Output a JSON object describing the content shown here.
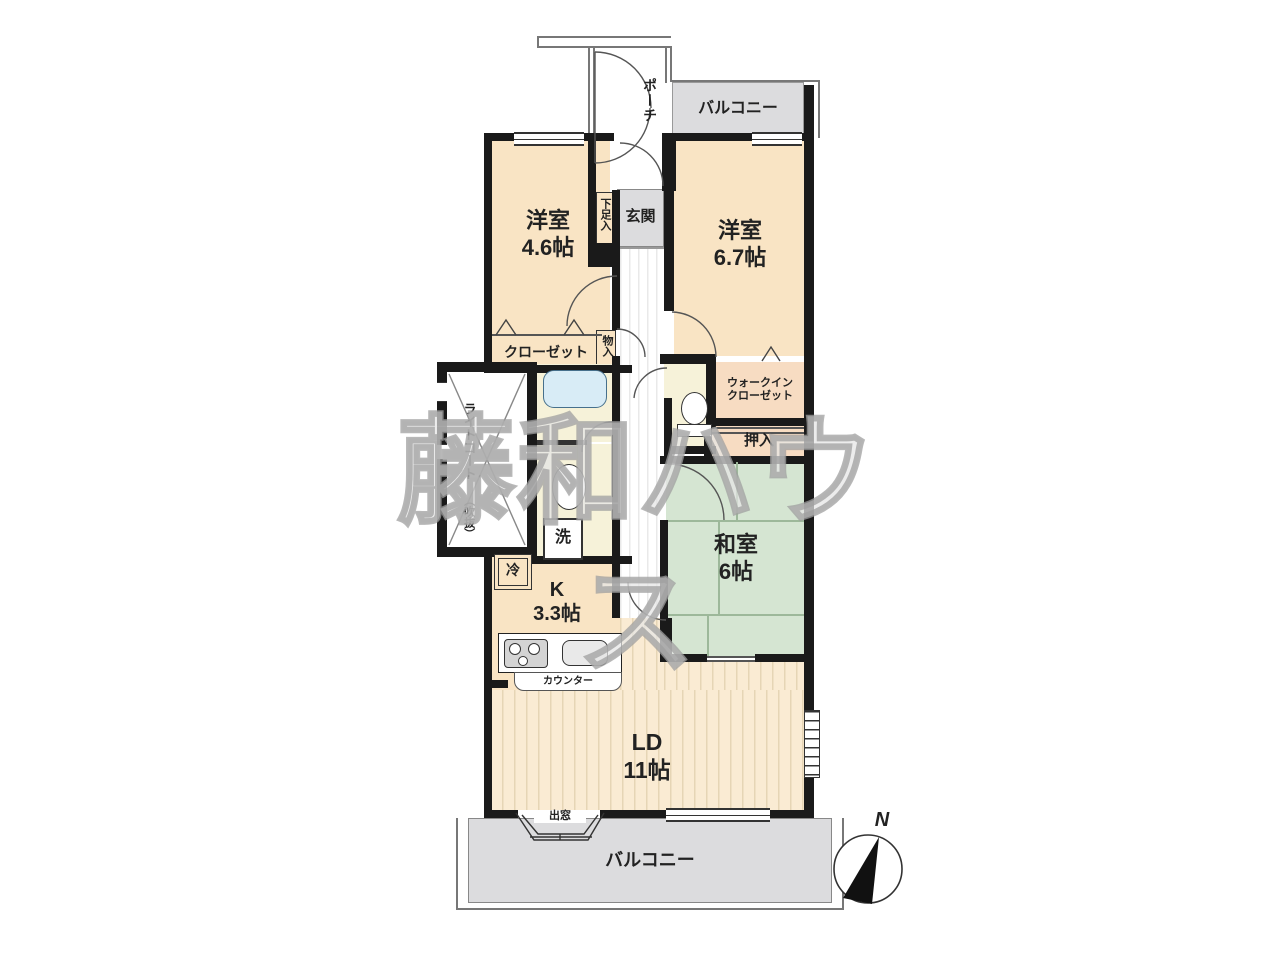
{
  "watermark": {
    "text": "藤和ハウス"
  },
  "compass": {
    "north_label": "N"
  },
  "rooms": {
    "porch": {
      "label": "ポーチ"
    },
    "balcony_top": {
      "label": "バルコニー"
    },
    "balcony_bottom": {
      "label": "バルコニー"
    },
    "entrance": {
      "label": "玄関"
    },
    "shoe_cabinet": {
      "label": "下足入"
    },
    "western_room_small": {
      "name": "洋室",
      "size": "4.6帖"
    },
    "western_room_large": {
      "name": "洋室",
      "size": "6.7帖"
    },
    "closet": {
      "label": "クローゼット"
    },
    "storage": {
      "label": "物入"
    },
    "light_court": {
      "label": "ライトコート",
      "sublabel": "（吹抜）"
    },
    "walk_in_closet": {
      "label_line1": "ウォークイン",
      "label_line2": "クローゼット"
    },
    "oshiire": {
      "label": "押入"
    },
    "japanese_room": {
      "name": "和室",
      "size": "6帖"
    },
    "kitchen": {
      "name": "K",
      "size": "3.3帖"
    },
    "living_dining": {
      "name": "LD",
      "size": "11帖"
    },
    "refrigerator": {
      "label": "冷"
    },
    "washing_machine": {
      "label": "洗"
    },
    "counter": {
      "label": "カウンター"
    },
    "bay_window": {
      "label": "出窓"
    }
  },
  "colors": {
    "wall": "#1a1a1a",
    "room_cream": "#f9e4c4",
    "closet_pink": "#f7dcc2",
    "entrance_gray": "#dcdcde",
    "tatami_green": "#d5e5d2",
    "bath_yellow": "#f6f2d9",
    "tub_blue": "#d8ecf6",
    "ld_floor": "#faebd3"
  }
}
